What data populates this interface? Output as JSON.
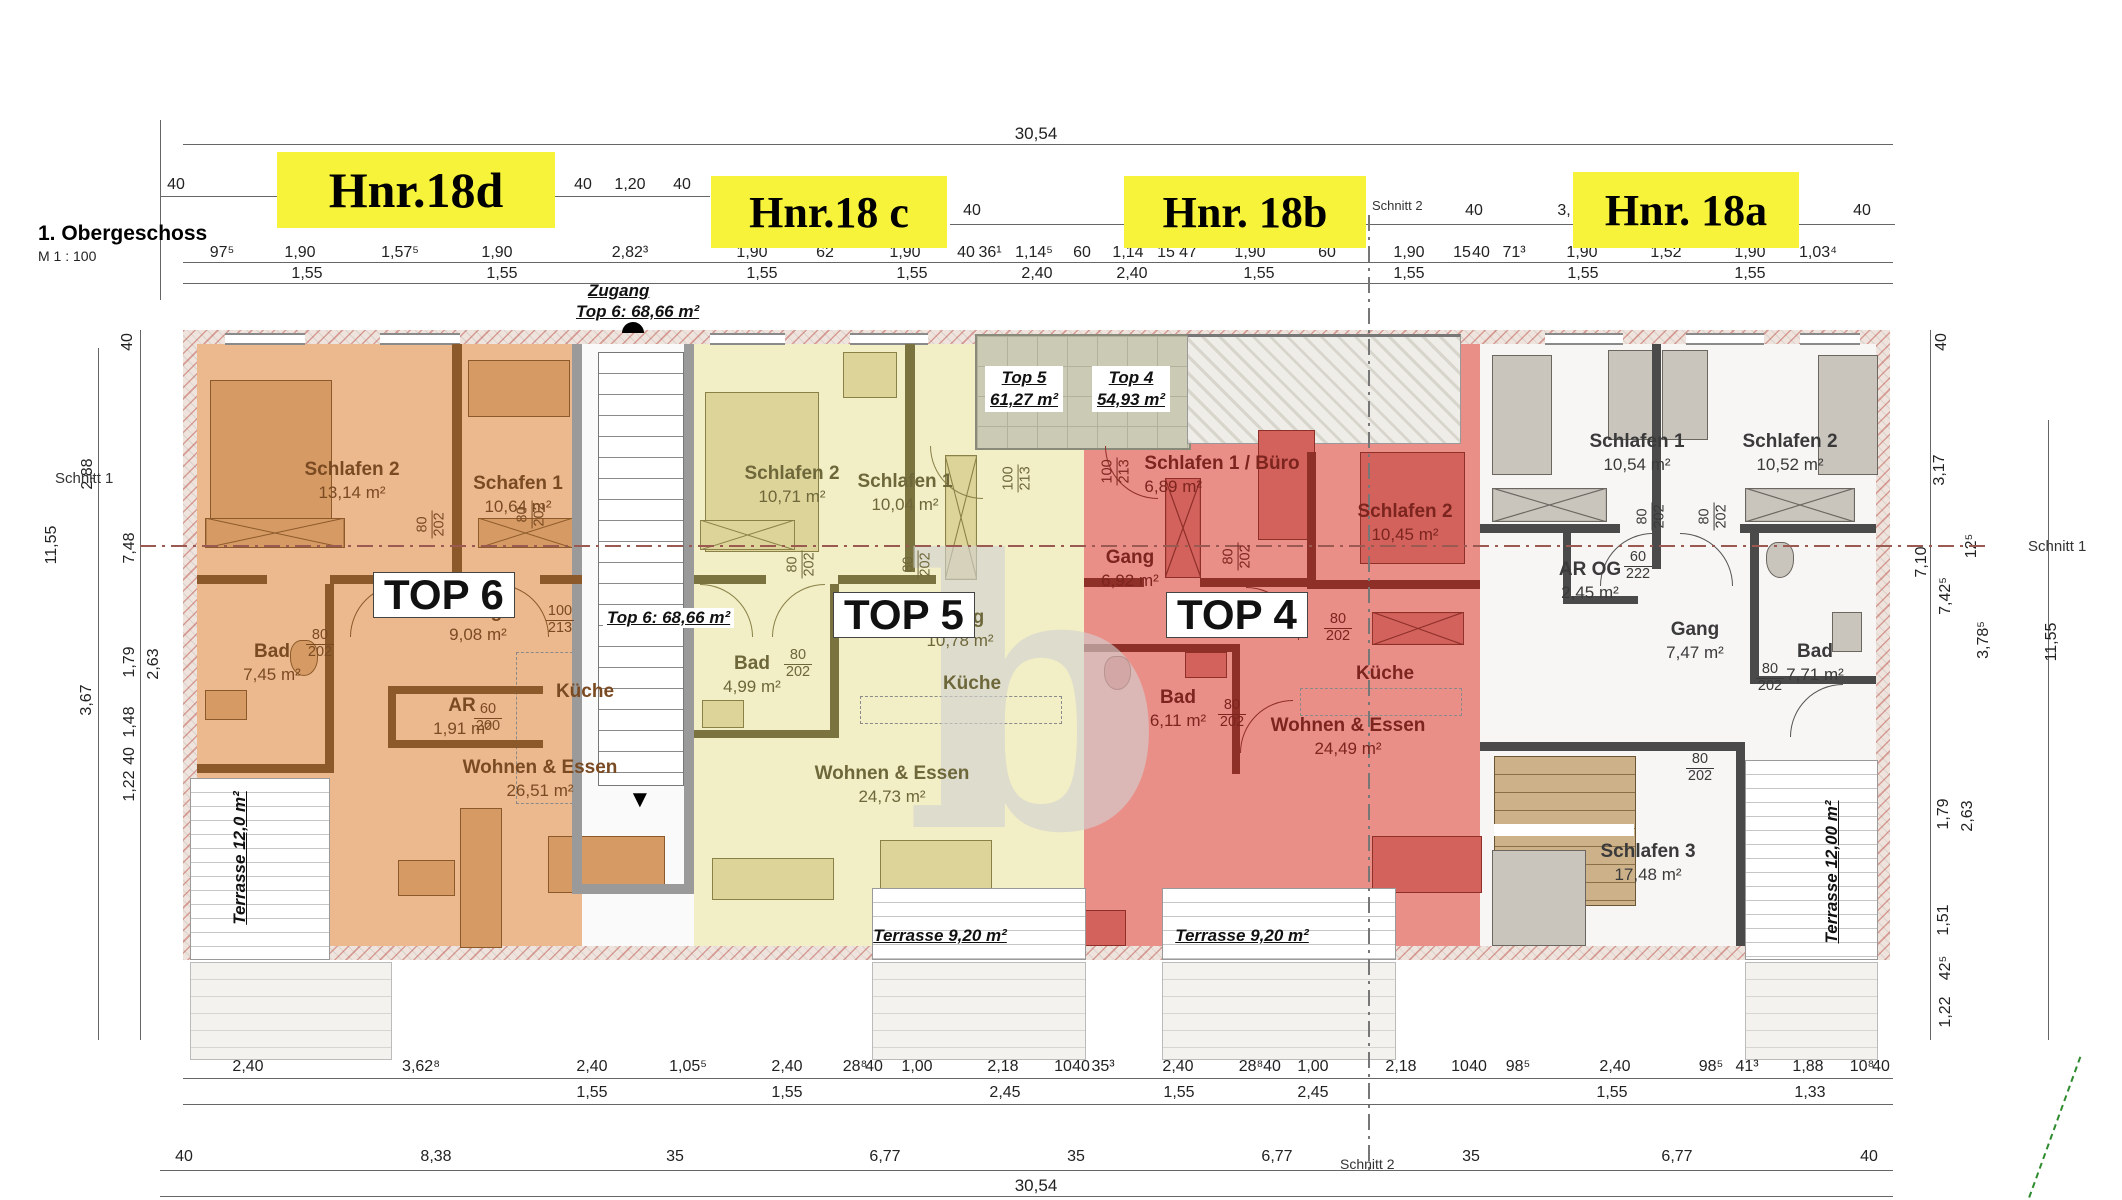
{
  "title_block": {
    "floor": "1. Obergeschoss",
    "scale": "M 1 : 100"
  },
  "highlight_labels": [
    "Hnr.18d",
    "Hnr.18 c",
    "Hnr. 18b",
    "Hnr. 18a"
  ],
  "section_marks": {
    "s1": "Schnitt 1",
    "s2": "Schnitt 2"
  },
  "watermark": "b",
  "colors": {
    "top6": "#ecb98e",
    "top5": "#f2eec5",
    "top4": "#ea8f88",
    "unit18a": "#f7f6f4",
    "highlight": "#f7f33b"
  },
  "entrance": {
    "line1": "Zugang",
    "line2": "Top 6: 68,66 m²"
  },
  "stair_area_label": "Top 6: 68,66 m²",
  "loggia": {
    "t5_name": "Top 5",
    "t5_area": "61,27 m²",
    "t4_name": "Top 4",
    "t4_area": "54,93 m²"
  },
  "units": {
    "top6": {
      "tag": "TOP 6",
      "terrace": "Terrasse 12,0 m²",
      "rooms": {
        "s2": {
          "n": "Schlafen 2",
          "a": "13,14 m²"
        },
        "s1": {
          "n": "Schafen 1",
          "a": "10,64 m²"
        },
        "gang": {
          "n": "Gang",
          "a": "9,08 m²"
        },
        "bad": {
          "n": "Bad",
          "a": "7,45 m²"
        },
        "ar": {
          "n": "AR",
          "a": "1,91 m²"
        },
        "kueche": {
          "n": "Küche"
        },
        "wohnen": {
          "n": "Wohnen & Essen",
          "a": "26,51 m²"
        }
      }
    },
    "top5": {
      "tag": "TOP 5",
      "terrace": "Terrasse 9,20 m²",
      "rooms": {
        "s2": {
          "n": "Schlafen 2",
          "a": "10,71 m²"
        },
        "s1": {
          "n": "Schlafen 1",
          "a": "10,04 m²"
        },
        "gang": {
          "n": "Gang",
          "a": "10,78 m²"
        },
        "bad": {
          "n": "Bad",
          "a": "4,99 m²"
        },
        "kueche": {
          "n": "Küche"
        },
        "wohnen": {
          "n": "Wohnen & Essen",
          "a": "24,73 m²"
        }
      }
    },
    "top4": {
      "tag": "TOP 4",
      "terrace": "Terrasse 9,20 m²",
      "rooms": {
        "s1": {
          "n": "Schlafen 1 / Büro",
          "a": "6,89 m²"
        },
        "s2": {
          "n": "Schlafen 2",
          "a": "10,45 m²"
        },
        "gang": {
          "n": "Gang",
          "a": "6,92 m²"
        },
        "bad": {
          "n": "Bad",
          "a": "6,11 m²"
        },
        "kueche": {
          "n": "Küche"
        },
        "wohnen": {
          "n": "Wohnen & Essen",
          "a": "24,49 m²"
        }
      }
    },
    "unit18a": {
      "terrace": "Terrasse 12,00 m²",
      "rooms": {
        "s1": {
          "n": "Schlafen 1",
          "a": "10,54 m²"
        },
        "s2": {
          "n": "Schlafen 2",
          "a": "10,52 m²"
        },
        "ar": {
          "n": "AR OG",
          "a": "2,45 m²"
        },
        "gang": {
          "n": "Gang",
          "a": "7,47 m²"
        },
        "bad": {
          "n": "Bad",
          "a": "7,71 m²"
        },
        "s3": {
          "n": "Schlafen 3",
          "a": "17,48 m²"
        }
      }
    }
  },
  "door_tags": {
    "w80": "80",
    "h202": "202",
    "w100": "100",
    "h213": "213",
    "w60": "60",
    "h200": "200",
    "h222": "222"
  },
  "dims": {
    "top_total": "30,54",
    "bottom_total": "30,54",
    "top_small": [
      "40",
      "40",
      "1,20",
      "40",
      "40",
      "40",
      "3,",
      "40"
    ],
    "rowA": [
      "97⁵",
      "1,90",
      "1,57⁵",
      "1,90",
      "2,82³",
      "1,90",
      "62",
      "1,90",
      "40",
      "36¹",
      "1,14⁵",
      "60",
      "1,14",
      "15",
      "47",
      "1,90",
      "60",
      "1,90",
      "15",
      "40",
      "71³",
      "1,90",
      "1,52",
      "1,90",
      "1,03⁴"
    ],
    "rowB": [
      "1,55",
      "1,55",
      "1,55",
      "1,55",
      "2,40",
      "2,40",
      "1,55",
      "1,55",
      "1,55",
      "1,55"
    ],
    "rowC": [
      "2,40",
      "3,62⁸",
      "2,40",
      "1,05⁵",
      "2,40",
      "28⁸",
      "40",
      "1,00",
      "2,18",
      "10",
      "40",
      "35³",
      "2,40",
      "28⁸",
      "40",
      "1,00",
      "2,18",
      "10",
      "40",
      "98⁵",
      "2,40",
      "98⁵",
      "41³",
      "1,88",
      "10⁸",
      "40"
    ],
    "rowD": [
      "1,55",
      "1,55",
      "2,45",
      "1,55",
      "2,45",
      "1,55",
      "1,33"
    ],
    "rowE": [
      "40",
      "8,38",
      "35",
      "6,77",
      "35",
      "6,77",
      "35",
      "6,77",
      "40"
    ],
    "left": [
      "40",
      "2,88",
      "7,48",
      "11,55",
      "1,79",
      "2,63",
      "3,67",
      "1,48",
      "40",
      "1,22"
    ],
    "right": [
      "40",
      "3,17",
      "12⁵",
      "7,10",
      "7,42⁵",
      "11,55",
      "3,78⁵",
      "1,79",
      "2,63",
      "1,51",
      "42⁵",
      "1,22"
    ]
  }
}
